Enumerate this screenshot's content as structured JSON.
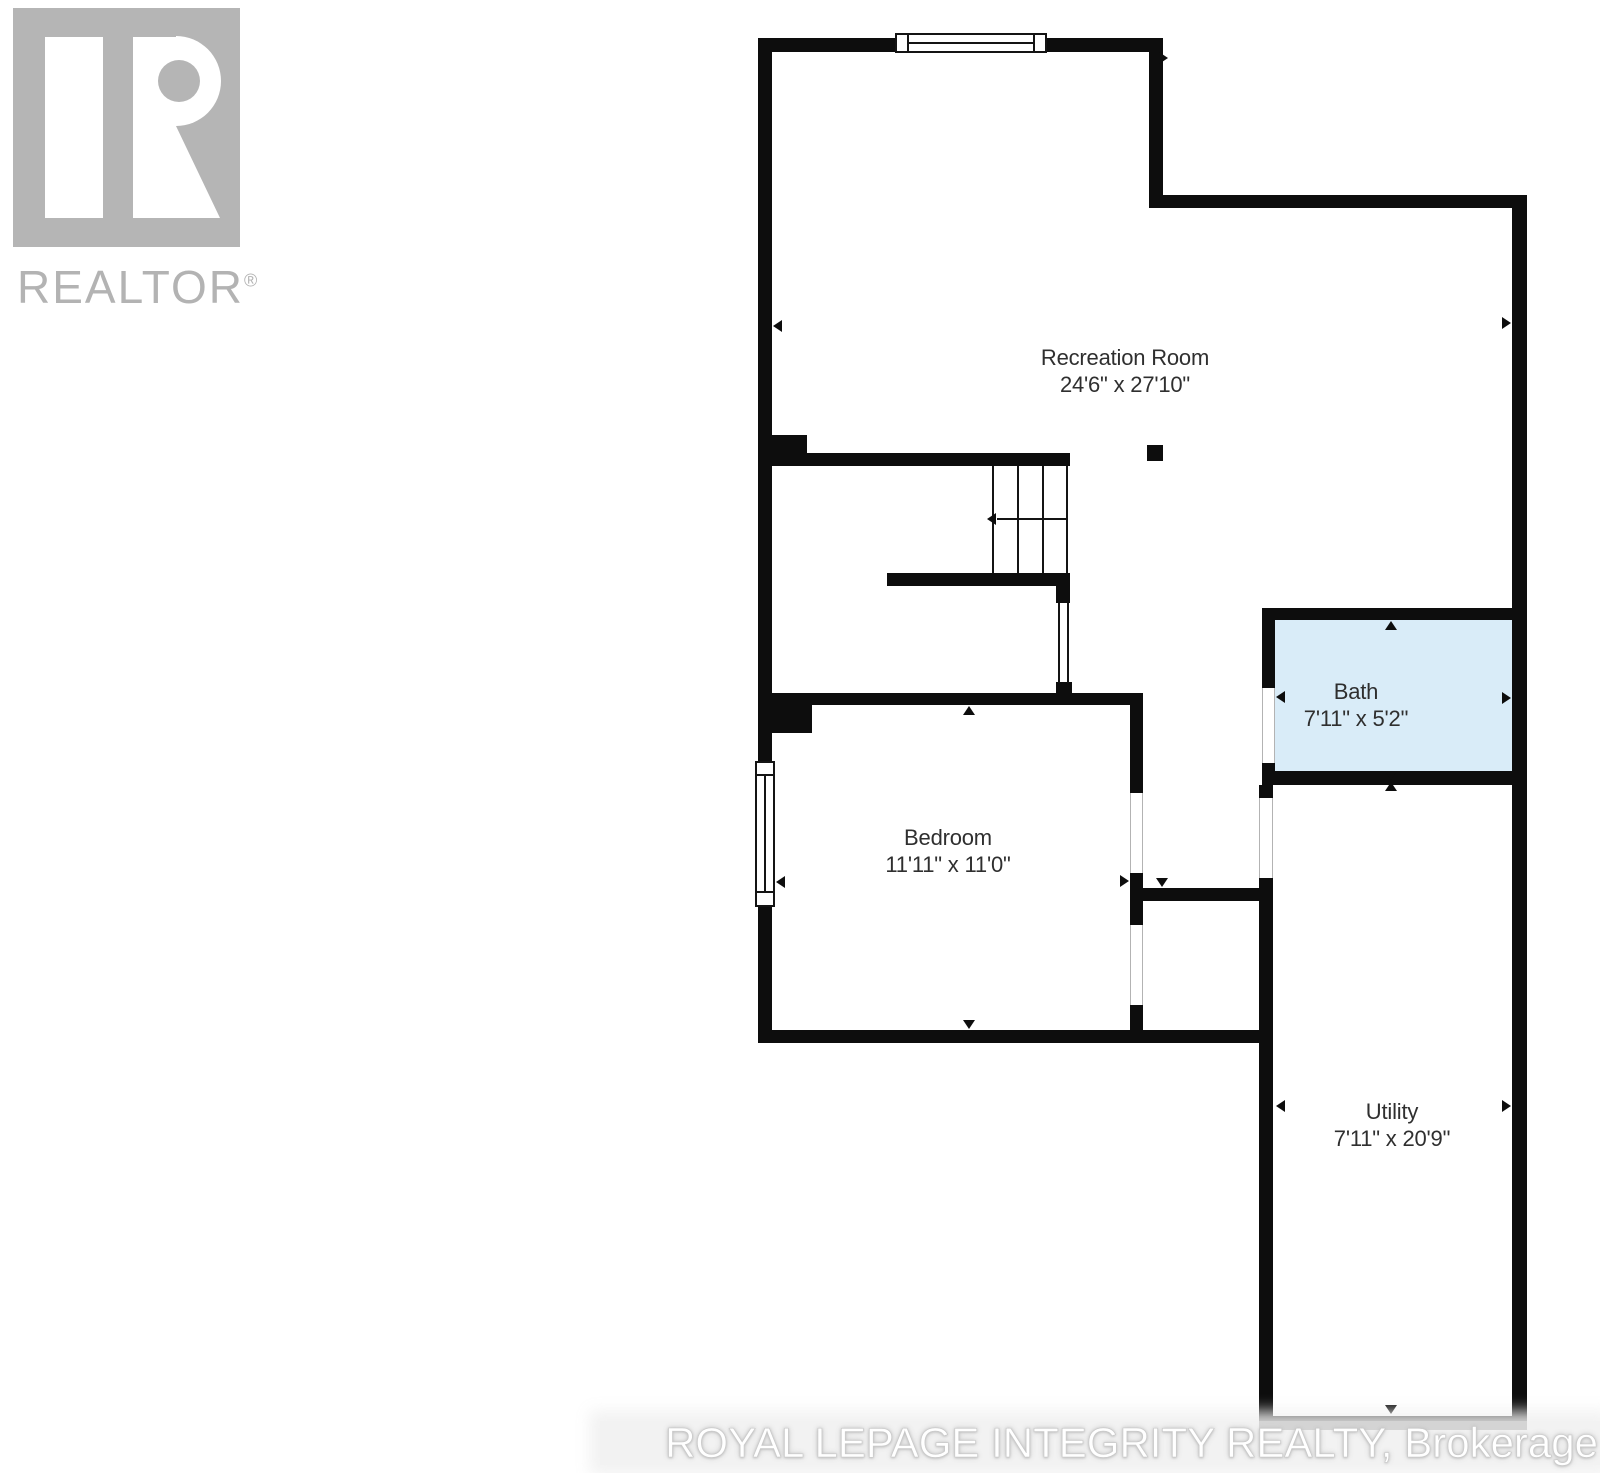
{
  "branding": {
    "logo_label": "REALTOR",
    "logo_registered_mark": "®",
    "logo_color": "#b5b5b5"
  },
  "floorplan": {
    "wall_color": "#0d0d0d",
    "rooms": [
      {
        "name": "Recreation Room",
        "dimensions": "24'6\" x 27'10\""
      },
      {
        "name": "Bath",
        "dimensions": "7'11\" x 5'2\"",
        "floor_fill": "#d9ecf8"
      },
      {
        "name": "Bedroom",
        "dimensions": "11'11\" x 11'0\""
      },
      {
        "name": "Utility",
        "dimensions": "7'11\" x 20'9\""
      }
    ]
  },
  "watermark": {
    "text": "ROYAL LEPAGE INTEGRITY REALTY, Brokerage"
  }
}
